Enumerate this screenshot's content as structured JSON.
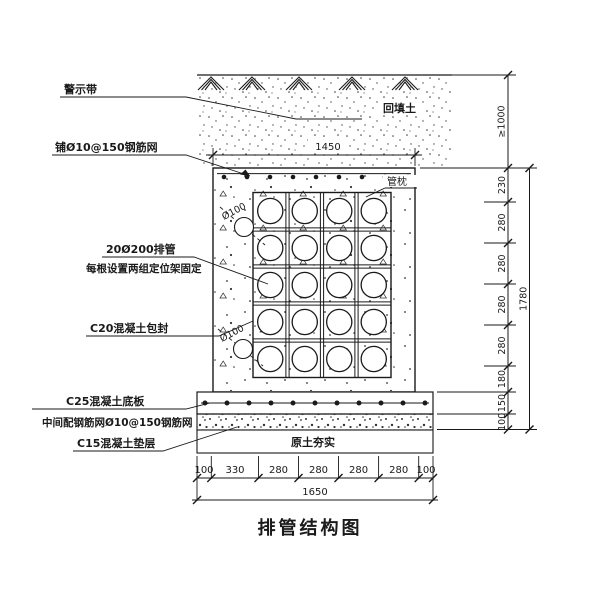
{
  "drawing": {
    "title": "排管结构图",
    "callouts": {
      "warning_tape": "警示带",
      "top_mesh": "铺Ø10@150钢筋网",
      "pipes_line1": "20Ø200排管",
      "pipes_line2": "每根设置两组定位架固定",
      "encasement": "C20混凝土包封",
      "base_slab": "C25混凝土底板",
      "mid_mesh": "中间配钢筋网Ø10@150钢筋网",
      "cushion": "C15混凝土垫层"
    },
    "annotations": {
      "backfill": "回填土",
      "pipe_pillow": "管枕",
      "compacted_soil": "原土夯实",
      "pipe_diameter": "Ø100"
    },
    "dimensions": {
      "top_width": "1450",
      "bottom_segments": [
        "100",
        "330",
        "280",
        "280",
        "280",
        "280",
        "100"
      ],
      "bottom_total": "1650",
      "right_top_cover": "≥1000",
      "right_segments": [
        "230",
        "280",
        "280",
        "280",
        "280",
        "180",
        "150",
        "100"
      ],
      "right_total": "1780"
    },
    "colors": {
      "ink": "#1a1a1a",
      "paper": "#ffffff"
    }
  }
}
